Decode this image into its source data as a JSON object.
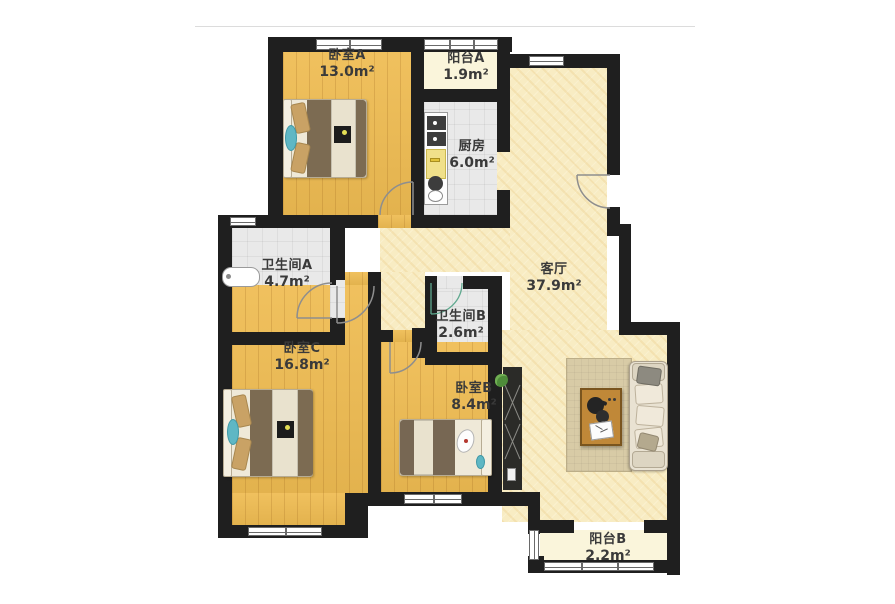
{
  "rooms": [
    {
      "name": "卧室A",
      "area": "13.0m²"
    },
    {
      "name": "阳台A",
      "area": "1.9m²"
    },
    {
      "name": "厨房",
      "area": "6.0m²"
    },
    {
      "name": "卫生间A",
      "area": "4.7m²"
    },
    {
      "name": "客厅",
      "area": "37.9m²"
    },
    {
      "name": "卫生间B",
      "area": "2.6m²"
    },
    {
      "name": "卧室C",
      "area": "16.8m²"
    },
    {
      "name": "卧室B",
      "area": "8.4m²"
    },
    {
      "name": "阳台B",
      "area": "2.2m²"
    }
  ],
  "colors": {
    "wall": "#1f1f1f",
    "wood-floor": "#efbc52",
    "living-floor": "#f8ecc3",
    "tile-floor": "#e9e9e9",
    "balcony-floor": "#faf5db",
    "label-text": "#3a3a3a",
    "door-arc": "#8e8e8e",
    "bath-door-accent": "#5fa98f",
    "teal-accent": "#5fb7c4",
    "duvet-brown": "#7c6b52",
    "pillow-tan": "#c9a265",
    "rug": "#d8cba6",
    "sofa": "#e9e2d2",
    "table-wood": "#c08838"
  }
}
